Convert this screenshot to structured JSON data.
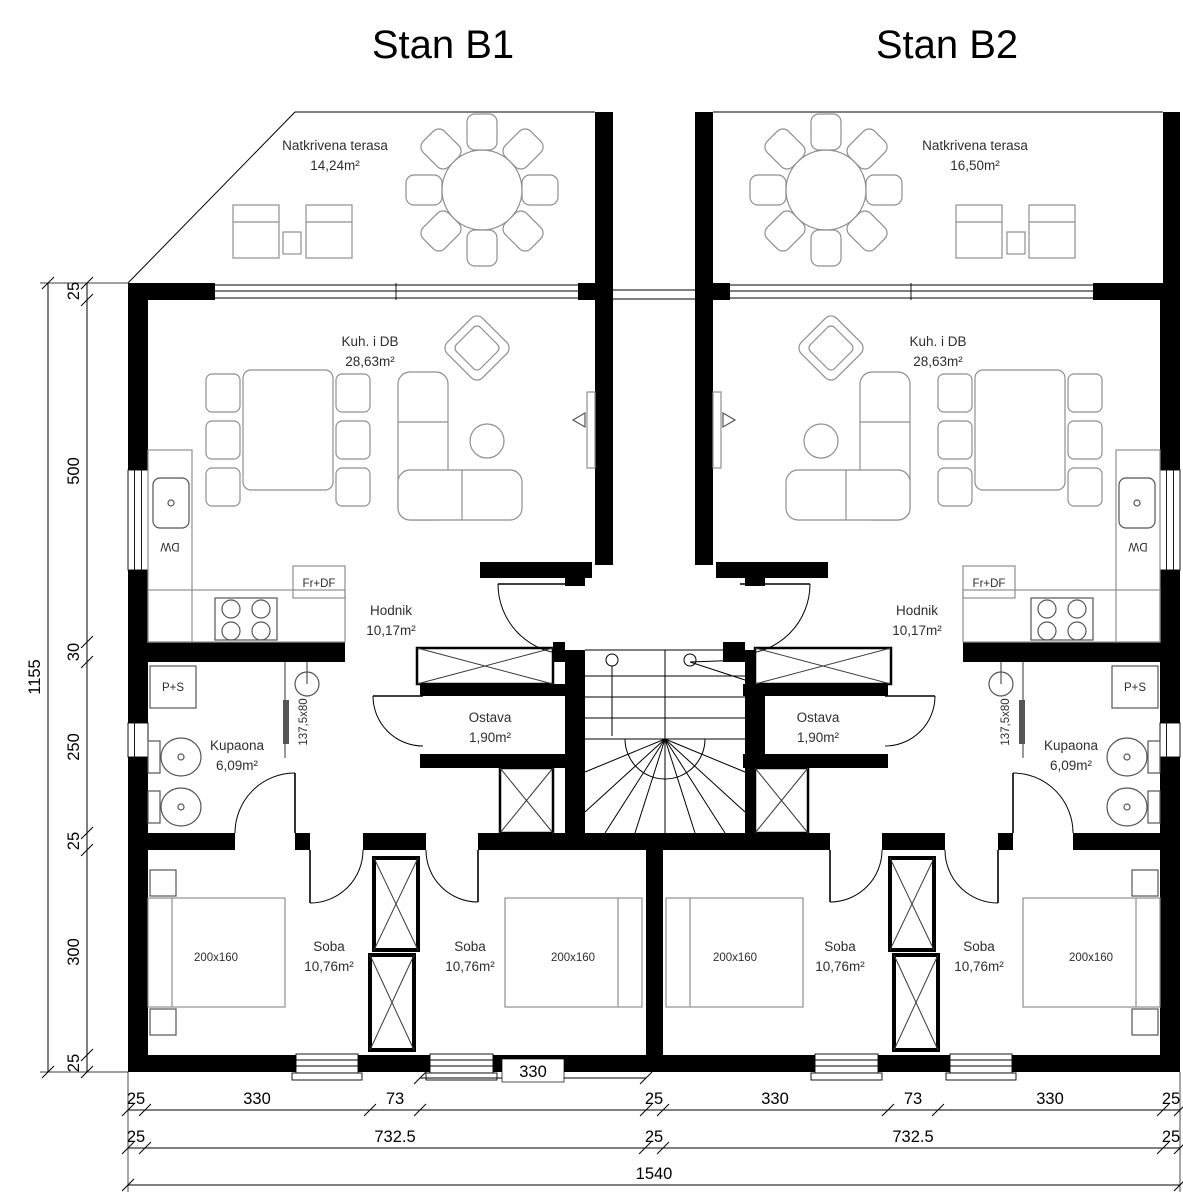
{
  "titles": {
    "b1": "Stan B1",
    "b2": "Stan B2"
  },
  "rooms": {
    "b1": {
      "terrace": {
        "name": "Natkrivena terasa",
        "area": "14,24m²"
      },
      "living": {
        "name": "Kuh. i DB",
        "area": "28,63m²"
      },
      "hall": {
        "name": "Hodnik",
        "area": "10,17m²"
      },
      "storage": {
        "name": "Ostava",
        "area": "1,90m²"
      },
      "bath": {
        "name": "Kupaona",
        "area": "6,09m²"
      },
      "bedroom1": {
        "name": "Soba",
        "area": "10,76m²",
        "bed": "200x160"
      },
      "bedroom2": {
        "name": "Soba",
        "area": "10,76m²",
        "bed": "200x160"
      }
    },
    "b2": {
      "terrace": {
        "name": "Natkrivena terasa",
        "area": "16,50m²"
      },
      "living": {
        "name": "Kuh. i DB",
        "area": "28,63m²"
      },
      "hall": {
        "name": "Hodnik",
        "area": "10,17m²"
      },
      "storage": {
        "name": "Ostava",
        "area": "1,90m²"
      },
      "bath": {
        "name": "Kupaona",
        "area": "6,09m²"
      },
      "bedroom1": {
        "name": "Soba",
        "area": "10,76m²",
        "bed": "200x160"
      },
      "bedroom2": {
        "name": "Soba",
        "area": "10,76m²",
        "bed": "200x160"
      }
    }
  },
  "fixtures": {
    "washer_dryer": "P+S",
    "fridge_freezer": "Fr+DF",
    "dishwasher": "DW",
    "shower_size": "137,5x80"
  },
  "dimensions": {
    "left_total": "1155",
    "left_chain": [
      "25",
      "500",
      "30",
      "250",
      "25",
      "300",
      "25"
    ],
    "bottom_chain": [
      "25",
      "330",
      "73",
      "330",
      "25",
      "330",
      "73",
      "330",
      "25"
    ],
    "bottom_chain2": [
      "25",
      "732.5",
      "25",
      "732.5",
      "25"
    ],
    "bottom_total": "1540"
  }
}
